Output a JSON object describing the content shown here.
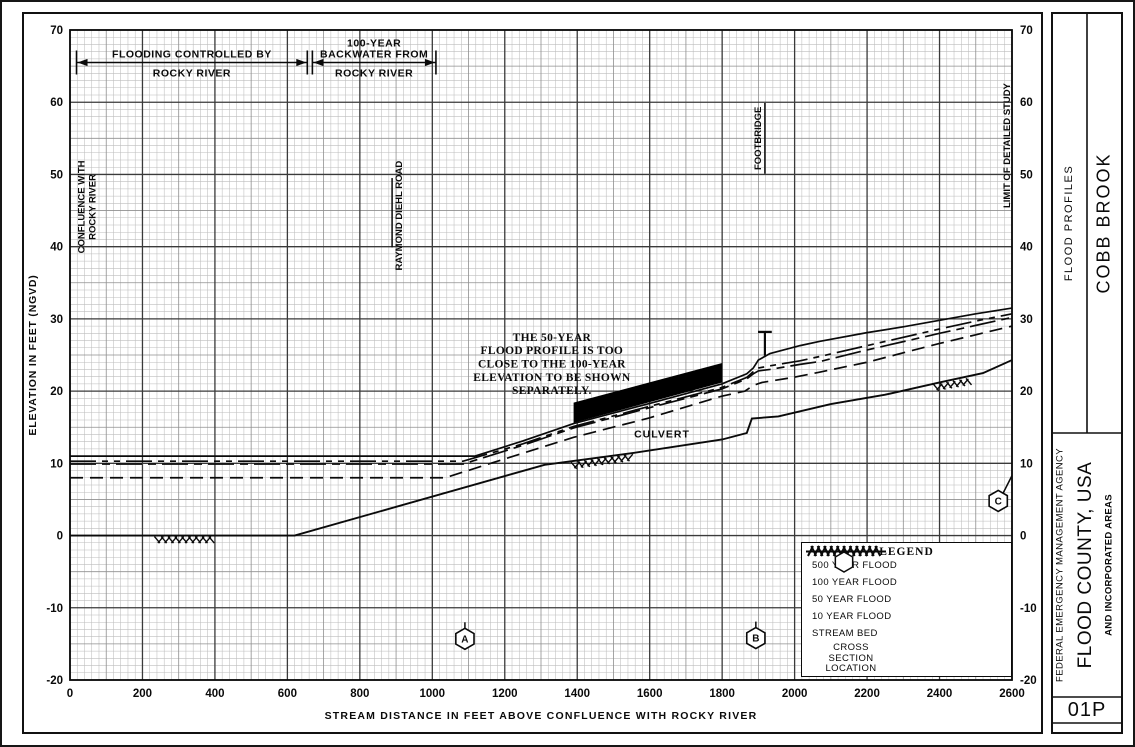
{
  "page": {
    "sidebar_label": "FLOOD PROFILES",
    "stream_name": "COBB BROOK",
    "agency": "FEDERAL EMERGENCY MANAGEMENT AGENCY",
    "community": "FLOOD COUNTY, USA",
    "community_sub": "AND INCORPORATED AREAS",
    "panel_number": "01P"
  },
  "chart_data": {
    "type": "line",
    "title": "FLOOD PROFILES — COBB BROOK",
    "xlabel": "STREAM DISTANCE IN FEET ABOVE CONFLUENCE WITH ROCKY RIVER",
    "ylabel": "ELEVATION IN FEET (NGVD)",
    "xlim": [
      0,
      2600
    ],
    "ylim": [
      -20,
      70
    ],
    "x_ticks": [
      0,
      200,
      400,
      600,
      800,
      1000,
      1200,
      1400,
      1600,
      1800,
      2000,
      2200,
      2400,
      2600
    ],
    "y_ticks": [
      70,
      60,
      50,
      40,
      30,
      20,
      10,
      0,
      -10,
      -20
    ],
    "grid": {
      "minor_x_ft": 20,
      "medium_x_ft": 100,
      "major_x_ft": 200,
      "minor_y_ft": 1,
      "medium_y_ft": 5,
      "major_y_ft": 10
    },
    "series": [
      {
        "name": "500 YEAR FLOOD",
        "style": "solid",
        "points": [
          [
            0,
            11
          ],
          [
            1118,
            11
          ],
          [
            1250,
            13.1
          ],
          [
            1390,
            15.5
          ],
          [
            1600,
            18.3
          ],
          [
            1799,
            21.0
          ],
          [
            1868,
            22.4
          ],
          [
            1886,
            23.2
          ],
          [
            1900,
            24.3
          ],
          [
            1932,
            25.2
          ],
          [
            2015,
            26.3
          ],
          [
            2070,
            26.9
          ],
          [
            2200,
            28.1
          ],
          [
            2300,
            28.9
          ],
          [
            2400,
            29.8
          ],
          [
            2500,
            30.7
          ],
          [
            2600,
            31.5
          ]
        ]
      },
      {
        "name": "100 YEAR FLOOD",
        "style": "dash-dot-dot",
        "points": [
          [
            0,
            10.3
          ],
          [
            1085,
            10.3
          ],
          [
            1250,
            12.7
          ],
          [
            1390,
            15.1
          ],
          [
            1600,
            17.9
          ],
          [
            1799,
            20.5
          ],
          [
            1868,
            21.9
          ],
          [
            1886,
            22.7
          ],
          [
            1900,
            23.2
          ],
          [
            1932,
            23.5
          ],
          [
            2015,
            24.2
          ],
          [
            2070,
            24.8
          ],
          [
            2200,
            26.3
          ],
          [
            2400,
            28.6
          ],
          [
            2500,
            29.7
          ],
          [
            2600,
            30.7
          ]
        ]
      },
      {
        "name": "50 YEAR FLOOD",
        "style": "dash-dot",
        "points": [
          [
            0,
            9.9
          ],
          [
            1085,
            9.9
          ],
          [
            1250,
            12.5
          ],
          [
            1390,
            14.9
          ],
          [
            1600,
            17.7
          ],
          [
            1799,
            20.3
          ],
          [
            1868,
            21.7
          ],
          [
            1886,
            22.4
          ],
          [
            1900,
            22.8
          ],
          [
            1932,
            23.0
          ],
          [
            2015,
            23.7
          ],
          [
            2070,
            24.1
          ],
          [
            2200,
            25.7
          ],
          [
            2400,
            28.0
          ],
          [
            2500,
            29.1
          ],
          [
            2600,
            30.2
          ]
        ]
      },
      {
        "name": "10 YEAR FLOOD",
        "style": "dashed",
        "points": [
          [
            0,
            8
          ],
          [
            1035,
            8
          ],
          [
            1250,
            11.4
          ],
          [
            1390,
            13.6
          ],
          [
            1600,
            16.3
          ],
          [
            1799,
            19.3
          ],
          [
            1863,
            20.0
          ],
          [
            1886,
            20.8
          ],
          [
            1910,
            21.2
          ],
          [
            1996,
            21.9
          ],
          [
            2067,
            22.6
          ],
          [
            2200,
            24.0
          ],
          [
            2400,
            26.6
          ],
          [
            2500,
            27.8
          ],
          [
            2600,
            29.0
          ]
        ]
      },
      {
        "name": "STREAM BED",
        "style": "solid-bed",
        "points": [
          [
            0,
            0
          ],
          [
            620,
            0
          ],
          [
            1310,
            9.8
          ],
          [
            1550,
            11.4
          ],
          [
            1800,
            13.3
          ],
          [
            1868,
            14.2
          ],
          [
            1882,
            16.2
          ],
          [
            1955,
            16.5
          ],
          [
            2100,
            18.2
          ],
          [
            2250,
            19.5
          ],
          [
            2400,
            21.2
          ],
          [
            2520,
            22.5
          ],
          [
            2600,
            24.3
          ]
        ]
      }
    ],
    "stream_bed_hatches": [
      [
        240,
        0,
        390,
        0
      ],
      [
        1390,
        10.3,
        1545,
        11.4
      ],
      [
        2390,
        21.1,
        2480,
        21.9
      ]
    ],
    "culvert": {
      "label": "CULVERT",
      "label_x": 1634,
      "label_elev": 13.6,
      "polygon": [
        [
          1390,
          15.6
        ],
        [
          1390,
          18.4
        ],
        [
          1800,
          23.9
        ],
        [
          1800,
          21.2
        ]
      ]
    },
    "footbridge_symbol": {
      "x": 1918,
      "base_elev": 24.9,
      "top_elev": 28.2,
      "cap_from_x": 1899,
      "cap_to_x": 1937
    },
    "zone_spans": [
      {
        "above": [
          "FLOODING CONTROLLED BY"
        ],
        "below": "ROCKY RIVER",
        "from_x": 18,
        "to_x": 655,
        "elev": 65.5
      },
      {
        "above": [
          "100-YEAR",
          "BACKWATER FROM"
        ],
        "below": "ROCKY RIVER",
        "from_x": 669,
        "to_x": 1010,
        "elev": 65.5
      }
    ],
    "structures": [
      {
        "label": "CONFLUENCE WITH\nROCKY RIVER",
        "x": 32,
        "elev_center": 45.5,
        "rule": null
      },
      {
        "label": "RAYMOND DIEHL ROAD",
        "x": 908,
        "elev_center": 44.3,
        "rule": {
          "x": 889,
          "from": 39.9,
          "to": 49.5
        }
      },
      {
        "label": "FOOTBRIDGE",
        "x": 1899,
        "elev_center": 55,
        "rule": {
          "x": 1918,
          "from": 50.1,
          "to": 59.9
        }
      },
      {
        "label": "LIMIT OF DETAILED STUDY",
        "x": 2586,
        "elev_center": 54,
        "rule": null
      }
    ],
    "note": {
      "lines": [
        "THE 50-YEAR",
        "FLOOD PROFILE IS TOO",
        "CLOSE TO THE 100-YEAR",
        "ELEVATION TO BE SHOWN",
        "SEPARATELY."
      ],
      "x": 1330,
      "elev_top": 28.2
    },
    "cross_sections": [
      {
        "id": "A",
        "x": 1090,
        "elev": -14.3
      },
      {
        "id": "B",
        "x": 1893,
        "elev": -14.2
      },
      {
        "id": "C",
        "x": 2562,
        "elev": 4.8,
        "leader_to": [
          2600,
          8.3
        ]
      }
    ],
    "legend": {
      "title": "LEGEND",
      "entries": [
        {
          "style": "solid",
          "label": "500 YEAR FLOOD"
        },
        {
          "style": "dash-dot-dot",
          "label": "100 YEAR FLOOD"
        },
        {
          "style": "dash-dot",
          "label": "50 YEAR FLOOD"
        },
        {
          "style": "dashed",
          "label": "10 YEAR FLOOD"
        },
        {
          "style": "streambed",
          "label": "STREAM BED"
        },
        {
          "style": "hexagon",
          "label": "CROSS SECTION\nLOCATION"
        }
      ]
    }
  }
}
